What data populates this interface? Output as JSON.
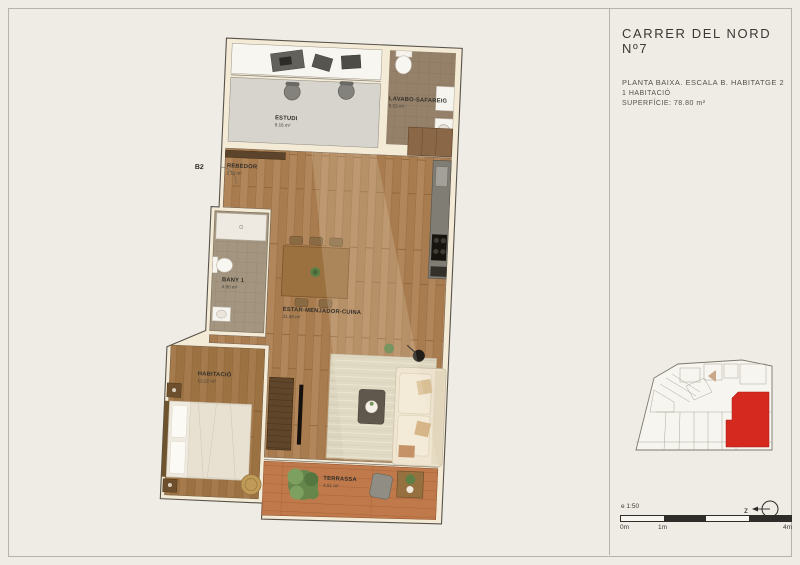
{
  "title_block": {
    "title": "CARRER DEL NORD Nº7",
    "line1": "PLANTA BAIXA. ESCALA B. HABITATGE 2",
    "line2": "1 HABITACIÓ",
    "line3": "SUPERFÍCIE: 78.80 m²"
  },
  "unit_label": "B2",
  "plan": {
    "rooms": [
      {
        "name": "ESTUDI",
        "area": "9.16 m²"
      },
      {
        "name": "LAVABO-SAFAREIG",
        "area": "5.03 m²"
      },
      {
        "name": "REBEDOR",
        "area": "2.11 m²"
      },
      {
        "name": "BANY 1",
        "area": "4.90 m²"
      },
      {
        "name": "ESTAR-MENJADOR-CUINA",
        "area": "31.59 m²"
      },
      {
        "name": "HABITACIÓ",
        "area": "12.22 m²"
      },
      {
        "name": "TERRASSA",
        "area": "4.81 m²"
      }
    ]
  },
  "legend": {
    "scale_label": "e 1:50",
    "tick_0": "0m",
    "tick_1": "1m",
    "tick_4": "4m",
    "north_letter": "z"
  },
  "colors": {
    "paper": "#eeece5",
    "wall_cream": "#f4ebd7",
    "wood_floor": "#a87c4e",
    "terrace_tile": "#c0794a",
    "highlight_red": "#d5291f"
  }
}
